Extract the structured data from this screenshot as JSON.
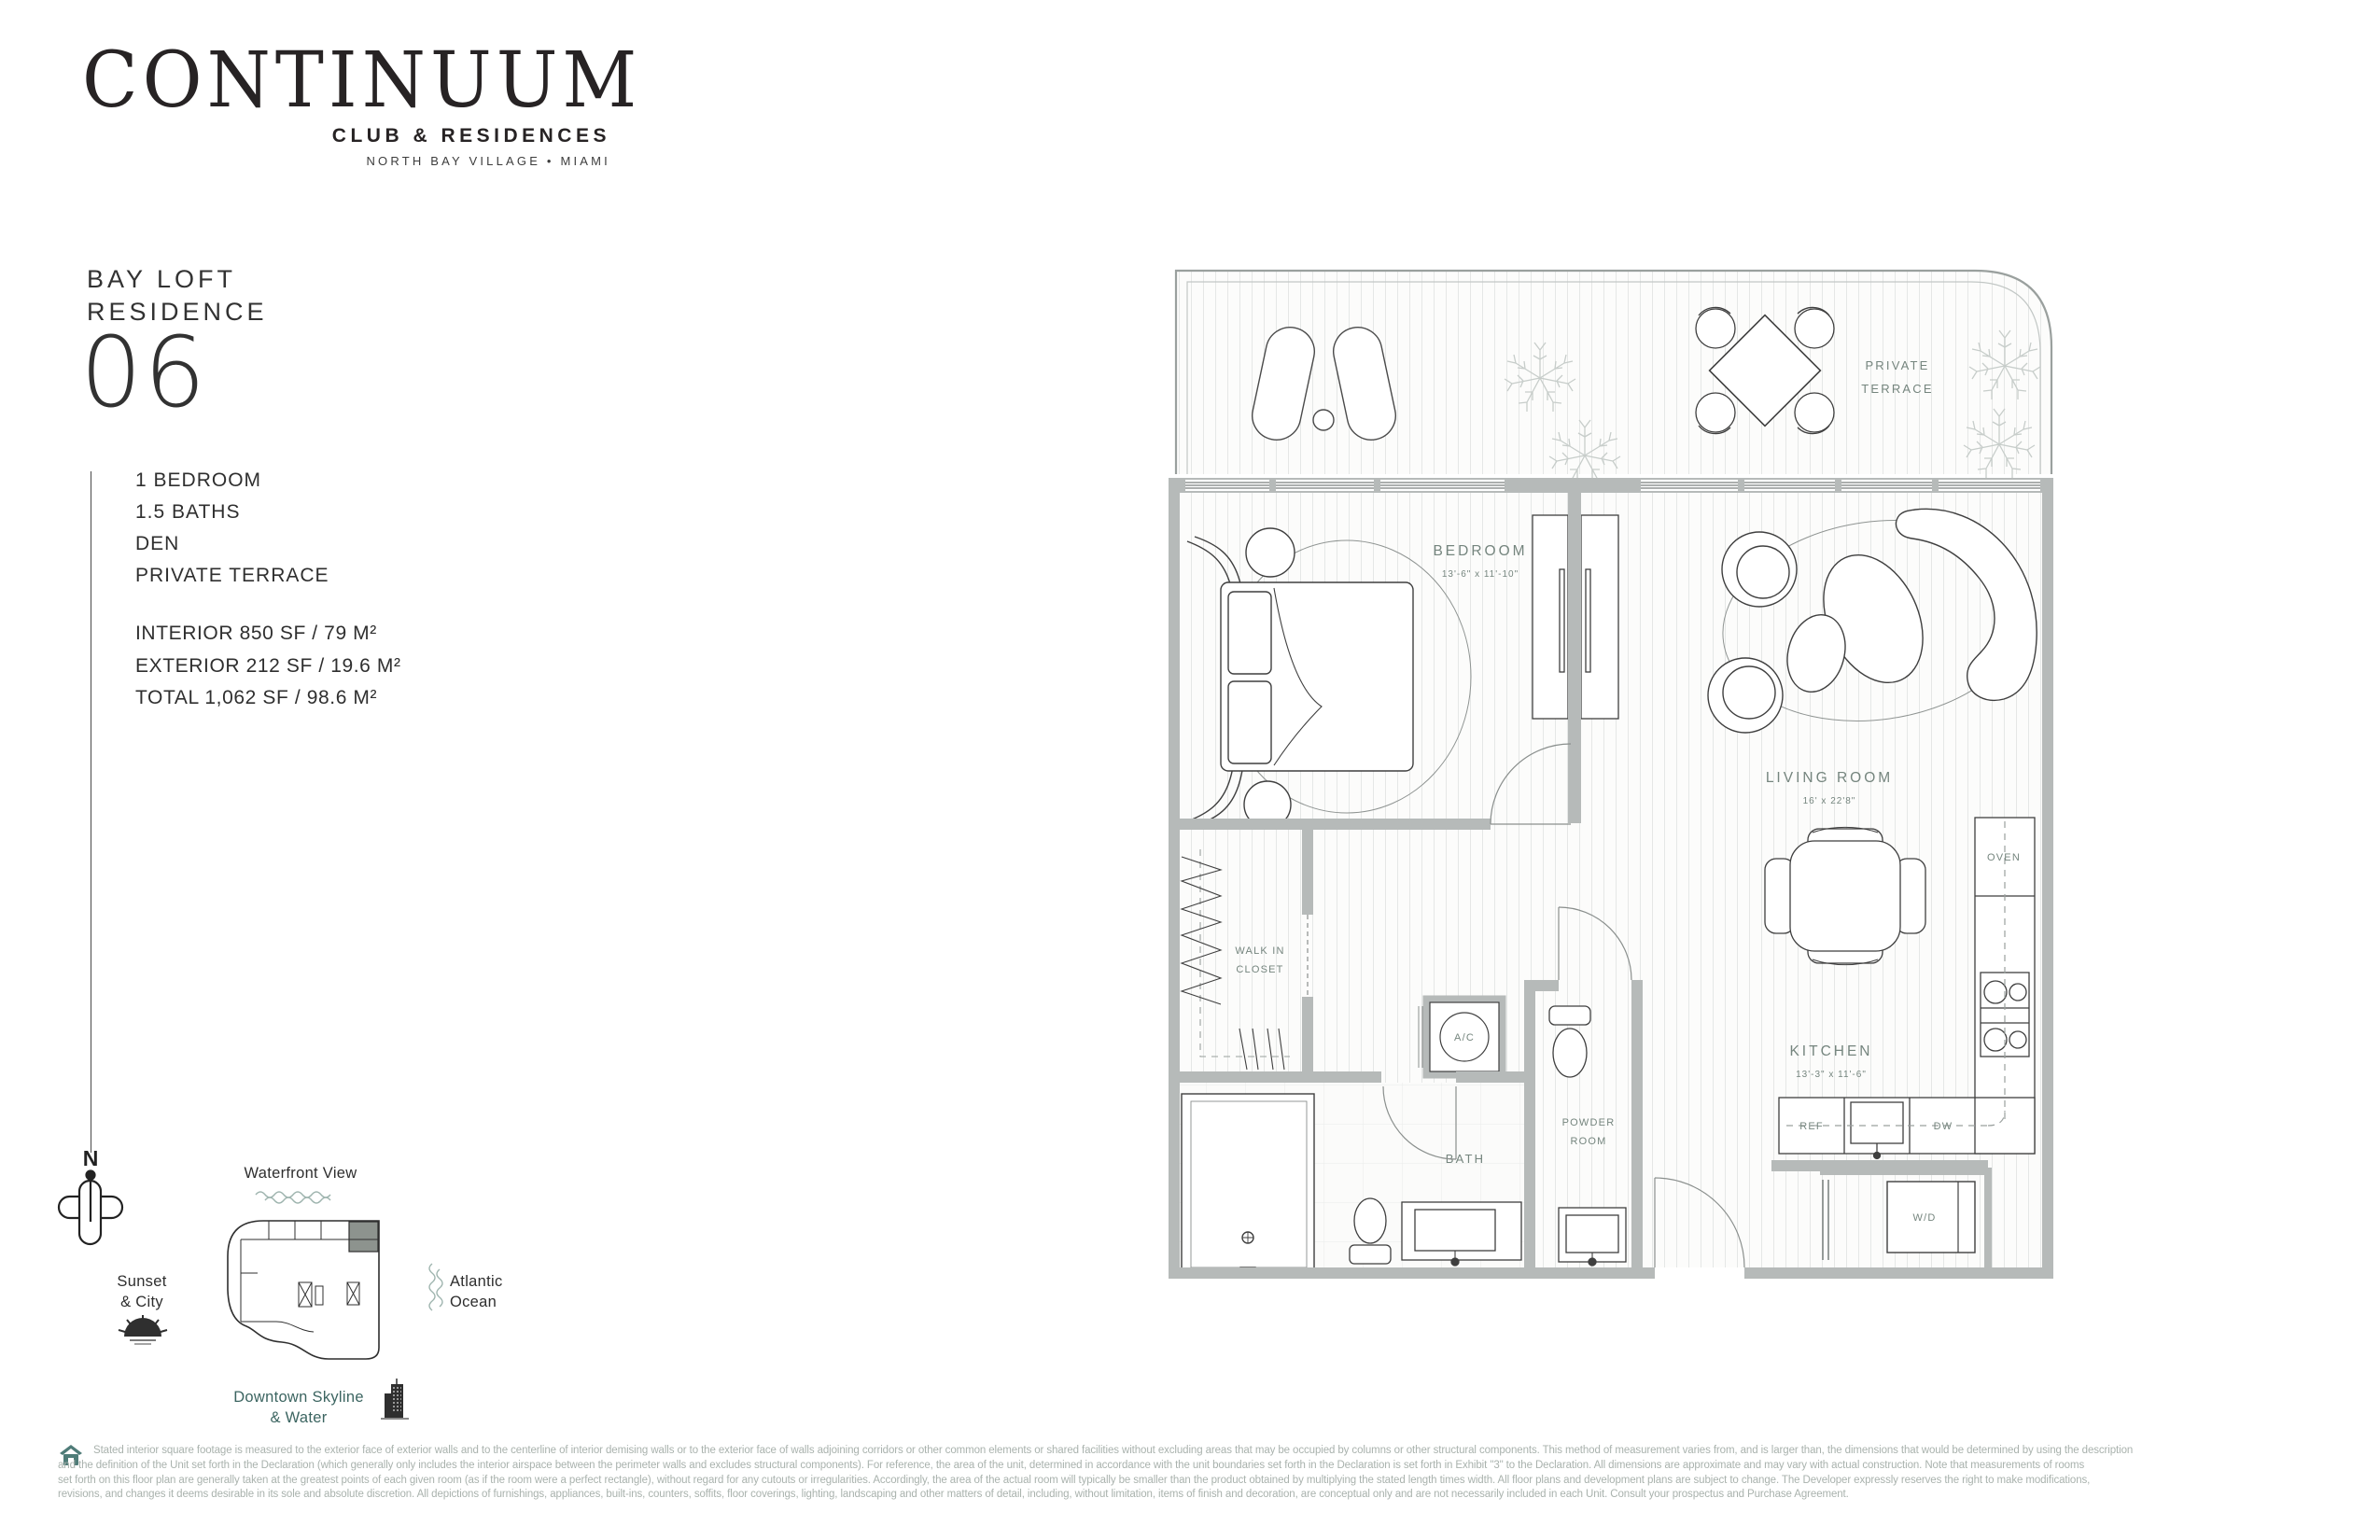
{
  "palette": {
    "label_green": "#75857e",
    "wall_gray": "#b6bab9",
    "text_dark": "#272324",
    "disclaimer_gray": "#a9b2ad",
    "teal": "#3c6561"
  },
  "brand": {
    "name": "CONTINUUM",
    "tagline": "CLUB & RESIDENCES",
    "location": "NORTH BAY VILLAGE • MIAMI"
  },
  "residence": {
    "type_line1": "BAY LOFT",
    "type_line2": "RESIDENCE",
    "number": "06",
    "features": [
      "1 BEDROOM",
      "1.5 BATHS",
      "DEN",
      "PRIVATE TERRACE"
    ],
    "areas": [
      "INTERIOR 850 SF /  79 M²",
      "EXTERIOR 212 SF /  19.6 M²",
      "TOTAL 1,062 SF / 98.6 M²"
    ]
  },
  "floorplan": {
    "terrace_line1": "PRIVATE",
    "terrace_line2": "TERRACE",
    "bedroom_name": "BEDROOM",
    "bedroom_dims": "13'-6\" x 11'-10\"",
    "living_name": "LIVING ROOM",
    "living_dims": "16' x 22'8\"",
    "kitchen_name": "KITCHEN",
    "kitchen_dims": "13'-3\" x 11'-6\"",
    "walkin_line1": "WALK IN",
    "walkin_line2": "CLOSET",
    "bath": "BATH",
    "powder_line1": "POWDER",
    "powder_line2": "ROOM",
    "ac": "A/C",
    "oven": "OVEN",
    "ref": "REF",
    "dw": "DW",
    "wd": "W/D"
  },
  "orientation": {
    "north": "N",
    "waterfront": "Waterfront View",
    "sunset_line1": "Sunset",
    "sunset_line2": "& City",
    "ocean_line1": "Atlantic",
    "ocean_line2": "Ocean",
    "downtown_line1": "Downtown Skyline",
    "downtown_line2": "& Water"
  },
  "disclaimer": {
    "line1": "Stated interior square footage is measured to the exterior face of exterior walls and to the centerline of interior demising walls or to the exterior face of walls adjoining corridors or other common elements or shared facilities without excluding areas that may be occupied by columns or other structural components. This method of measurement varies from, and is larger than, the dimensions that would be determined by using the description",
    "line2": "and the definition of the Unit set forth in the Declaration (which generally only includes the interior airspace between the perimeter walls and excludes structural components). For reference, the area of the unit, determined in accordance with the unit boundaries set forth in the Declaration is set forth in Exhibit \"3\" to the Declaration. All dimensions are approximate and may vary with actual construction. Note that measurements of rooms",
    "line3": "set forth on this floor plan are generally taken at the greatest points of each given room (as if the room were a perfect rectangle), without regard for any cutouts or irregularities. Accordingly, the area of the actual room will typically be smaller than the product obtained by multiplying the stated length times width. All floor plans and development plans are subject to change. The Developer expressly reserves the right to make modifications,",
    "line4": "revisions, and changes it deems desirable in its sole and absolute discretion. All depictions of furnishings, appliances, built-ins, counters, soffits, floor coverings, lighting, landscaping and other matters of detail, including, without limitation, items of finish and decoration, are conceptual only and are not necessarily included in each Unit. Consult your prospectus and Purchase Agreement."
  }
}
